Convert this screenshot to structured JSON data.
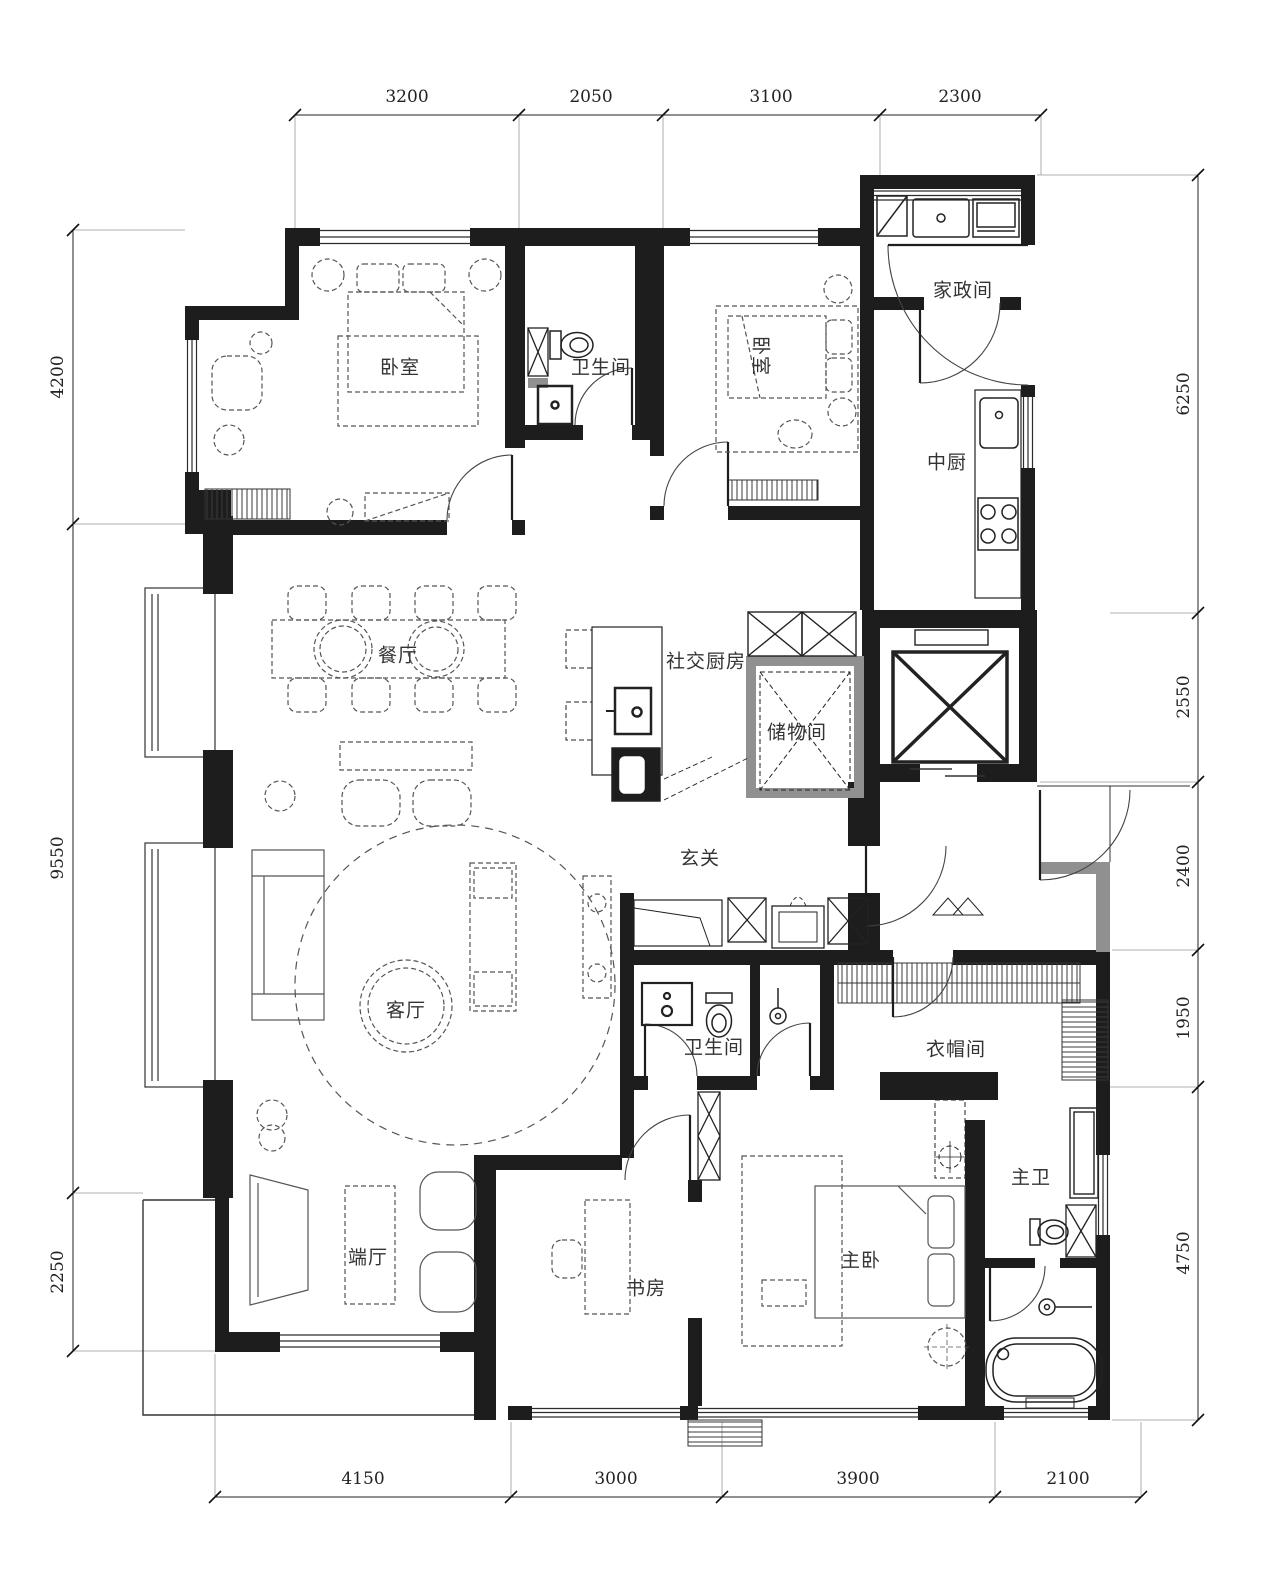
{
  "page": {
    "background": "#ffffff",
    "type": "apartment-floor-plan"
  },
  "colors": {
    "wall": "#1d1d1d",
    "thin_line": "#333333",
    "furniture": "#555555",
    "gray_wall": "#909090",
    "dimension_text": "#222222",
    "label_text": "#333333"
  },
  "rooms": [
    {
      "id": "bedroom-1",
      "label": "卧室"
    },
    {
      "id": "bathroom-1",
      "label": "卫生间"
    },
    {
      "id": "bedroom-2",
      "label": "卧室"
    },
    {
      "id": "laundry-room",
      "label": "家政间"
    },
    {
      "id": "chinese-kitchen",
      "label": "中厨"
    },
    {
      "id": "dining-room",
      "label": "餐厅"
    },
    {
      "id": "social-kitchen",
      "label": "社交厨房"
    },
    {
      "id": "storage-room",
      "label": "储物间"
    },
    {
      "id": "foyer",
      "label": "玄关"
    },
    {
      "id": "living-room",
      "label": "客厅"
    },
    {
      "id": "bathroom-2",
      "label": "卫生间"
    },
    {
      "id": "cloakroom",
      "label": "衣帽间"
    },
    {
      "id": "master-bath",
      "label": "主卫"
    },
    {
      "id": "end-hall",
      "label": "端厅"
    },
    {
      "id": "study",
      "label": "书房"
    },
    {
      "id": "master-bedroom",
      "label": "主卧"
    }
  ],
  "dimensions": {
    "top": [
      "3200",
      "2050",
      "3100",
      "2300"
    ],
    "left": [
      "4200",
      "9550",
      "2250"
    ],
    "right": [
      "6250",
      "2550",
      "2400",
      "1950",
      "4750"
    ],
    "bottom": [
      "4150",
      "3000",
      "3900",
      "2100"
    ]
  }
}
